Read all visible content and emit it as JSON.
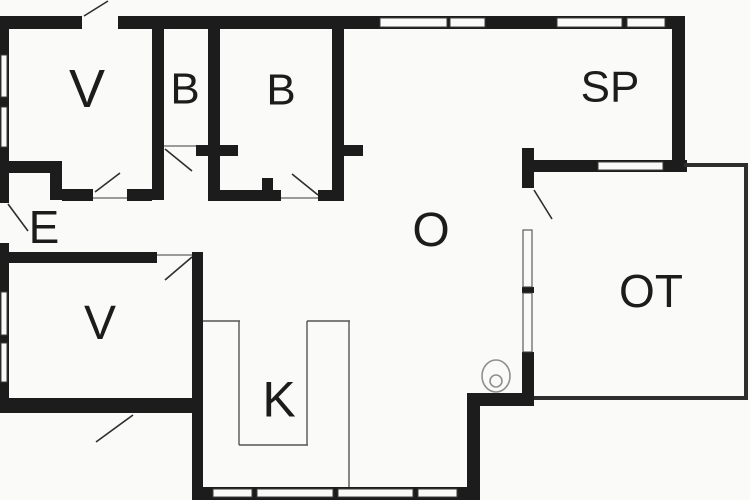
{
  "canvas": {
    "width": 750,
    "height": 500,
    "background": "#fafaf8",
    "wall_color": "#1c1c1c",
    "edge_color": "#2e2e2e",
    "line_color": "#3c3c3c",
    "counter_color": "#555555",
    "symbol_color": "#8f8f8f",
    "text_color": "#1c1c1c"
  },
  "rooms": [
    {
      "name": "room-label-bedroom-1",
      "label": "V",
      "x": 87,
      "y": 88,
      "size": 54
    },
    {
      "name": "room-label-bath-1",
      "label": "B",
      "x": 185,
      "y": 88,
      "size": 44
    },
    {
      "name": "room-label-bath-2",
      "label": "B",
      "x": 281,
      "y": 89,
      "size": 44
    },
    {
      "name": "room-label-dining",
      "label": "SP",
      "x": 610,
      "y": 86,
      "size": 44
    },
    {
      "name": "room-label-entry",
      "label": "E",
      "x": 44,
      "y": 227,
      "size": 46
    },
    {
      "name": "room-label-living",
      "label": "O",
      "x": 431,
      "y": 229,
      "size": 48
    },
    {
      "name": "room-label-bedroom-2",
      "label": "V",
      "x": 100,
      "y": 322,
      "size": 48
    },
    {
      "name": "room-label-kitchen",
      "label": "K",
      "x": 279,
      "y": 399,
      "size": 50
    },
    {
      "name": "room-label-terrace",
      "label": "OT",
      "x": 651,
      "y": 291,
      "size": 46
    }
  ],
  "walls": [
    {
      "name": "wall-top",
      "x": 8,
      "y": 16,
      "w": 677,
      "h": 13
    },
    {
      "name": "wall-left",
      "x": 0,
      "y": 16,
      "w": 9,
      "h": 397
    },
    {
      "name": "wall-v2-bottom",
      "x": 0,
      "y": 398,
      "w": 203,
      "h": 15
    },
    {
      "name": "wall-v2-right-k-left",
      "x": 192,
      "y": 252,
      "w": 11,
      "h": 248
    },
    {
      "name": "wall-k-bottom",
      "x": 192,
      "y": 487,
      "w": 288,
      "h": 13
    },
    {
      "name": "wall-k-right",
      "x": 467,
      "y": 393,
      "w": 13,
      "h": 107
    },
    {
      "name": "wall-o-bottom",
      "x": 467,
      "y": 393,
      "w": 67,
      "h": 13
    },
    {
      "name": "wall-ot-left-upper",
      "x": 522,
      "y": 148,
      "w": 12,
      "h": 40
    },
    {
      "name": "wall-ot-left-mullion",
      "x": 522,
      "y": 287,
      "w": 12,
      "h": 6
    },
    {
      "name": "wall-ot-left-lower",
      "x": 522,
      "y": 352,
      "w": 12,
      "h": 54
    },
    {
      "name": "wall-sp-bottom",
      "x": 522,
      "y": 160,
      "w": 165,
      "h": 12
    },
    {
      "name": "wall-sp-right",
      "x": 672,
      "y": 16,
      "w": 13,
      "h": 156
    },
    {
      "name": "wall-v1-b1",
      "x": 152,
      "y": 16,
      "w": 12,
      "h": 184
    },
    {
      "name": "wall-e-step-top",
      "x": 0,
      "y": 161,
      "w": 62,
      "h": 12
    },
    {
      "name": "wall-e-step-jog",
      "x": 50,
      "y": 173,
      "w": 12,
      "h": 27
    },
    {
      "name": "wall-v1-bottom-left",
      "x": 62,
      "y": 189,
      "w": 31,
      "h": 12
    },
    {
      "name": "wall-v1-bottom-right",
      "x": 127,
      "y": 189,
      "w": 25,
      "h": 12
    },
    {
      "name": "wall-b1-b2",
      "x": 208,
      "y": 16,
      "w": 12,
      "h": 185
    },
    {
      "name": "wall-b1-bottom-stub",
      "x": 196,
      "y": 145,
      "w": 42,
      "h": 11
    },
    {
      "name": "wall-b2-bottom-left",
      "x": 208,
      "y": 190,
      "w": 73,
      "h": 11
    },
    {
      "name": "wall-b2-bottom-right",
      "x": 318,
      "y": 190,
      "w": 26,
      "h": 11
    },
    {
      "name": "wall-b2-stub",
      "x": 262,
      "y": 178,
      "w": 11,
      "h": 12
    },
    {
      "name": "wall-b2-o",
      "x": 332,
      "y": 16,
      "w": 12,
      "h": 181
    },
    {
      "name": "wall-b2-o-stub",
      "x": 344,
      "y": 145,
      "w": 19,
      "h": 11
    },
    {
      "name": "wall-v2-top",
      "x": 0,
      "y": 252,
      "w": 157,
      "h": 11
    }
  ],
  "terrace_edges": [
    {
      "name": "terrace-edge-top",
      "x": 684,
      "y": 163,
      "w": 64,
      "h": 4
    },
    {
      "name": "terrace-edge-right",
      "x": 744,
      "y": 163,
      "w": 4,
      "h": 237
    },
    {
      "name": "terrace-edge-bottom",
      "x": 534,
      "y": 396,
      "w": 214,
      "h": 4
    }
  ],
  "door_gaps": [
    {
      "name": "gap-front-door",
      "x": 82,
      "y": 14,
      "w": 36,
      "h": 17
    },
    {
      "name": "gap-entry-door",
      "x": -1,
      "y": 203,
      "w": 11,
      "h": 40
    }
  ],
  "windows": [
    {
      "name": "window-top-1",
      "x": 380,
      "y": 18,
      "w": 67,
      "h": 9
    },
    {
      "name": "window-top-2",
      "x": 450,
      "y": 18,
      "w": 35,
      "h": 9
    },
    {
      "name": "window-top-3",
      "x": 557,
      "y": 18,
      "w": 65,
      "h": 9
    },
    {
      "name": "window-top-4",
      "x": 627,
      "y": 18,
      "w": 38,
      "h": 9
    },
    {
      "name": "window-left-1",
      "x": 1,
      "y": 55,
      "w": 6,
      "h": 42
    },
    {
      "name": "window-left-2",
      "x": 1,
      "y": 107,
      "w": 6,
      "h": 40
    },
    {
      "name": "window-left-3",
      "x": 1,
      "y": 292,
      "w": 6,
      "h": 43
    },
    {
      "name": "window-left-4",
      "x": 1,
      "y": 343,
      "w": 6,
      "h": 39
    },
    {
      "name": "window-sp-bottom",
      "x": 598,
      "y": 162,
      "w": 65,
      "h": 8
    },
    {
      "name": "window-ot-1",
      "x": 523,
      "y": 230,
      "w": 9,
      "h": 57
    },
    {
      "name": "window-ot-2",
      "x": 523,
      "y": 293,
      "w": 9,
      "h": 59
    },
    {
      "name": "window-k-1",
      "x": 213,
      "y": 489,
      "w": 39,
      "h": 8
    },
    {
      "name": "window-k-2",
      "x": 257,
      "y": 489,
      "w": 76,
      "h": 8
    },
    {
      "name": "window-k-3",
      "x": 338,
      "y": 489,
      "w": 75,
      "h": 8
    },
    {
      "name": "window-k-4",
      "x": 418,
      "y": 489,
      "w": 39,
      "h": 8
    }
  ],
  "thresholds": [
    {
      "name": "threshold-b1",
      "x1": 164,
      "y1": 146,
      "x2": 196,
      "y2": 146
    },
    {
      "name": "threshold-v1",
      "x1": 93,
      "y1": 198,
      "x2": 127,
      "y2": 198
    },
    {
      "name": "threshold-b2",
      "x1": 281,
      "y1": 198,
      "x2": 318,
      "y2": 198
    },
    {
      "name": "threshold-v2",
      "x1": 157,
      "y1": 255,
      "x2": 192,
      "y2": 255
    }
  ],
  "door_swings": [
    {
      "name": "door-swing-front",
      "x1": 84,
      "y1": 16,
      "x2": 108,
      "y2": 1
    },
    {
      "name": "door-swing-entry",
      "x1": 8,
      "y1": 204,
      "x2": 28,
      "y2": 231
    },
    {
      "name": "door-swing-v1",
      "x1": 95,
      "y1": 192,
      "x2": 120,
      "y2": 173
    },
    {
      "name": "door-swing-b1",
      "x1": 165,
      "y1": 149,
      "x2": 192,
      "y2": 171
    },
    {
      "name": "door-swing-b2",
      "x1": 292,
      "y1": 174,
      "x2": 318,
      "y2": 195
    },
    {
      "name": "door-swing-v2",
      "x1": 165,
      "y1": 280,
      "x2": 192,
      "y2": 257
    },
    {
      "name": "door-swing-v2-ext",
      "x1": 96,
      "y1": 442,
      "x2": 133,
      "y2": 415
    },
    {
      "name": "door-swing-ot",
      "x1": 534,
      "y1": 190,
      "x2": 552,
      "y2": 219
    }
  ],
  "counter_lines": [
    {
      "name": "counter-left",
      "x1": 203,
      "y1": 321,
      "x2": 240,
      "y2": 321
    },
    {
      "name": "counter-island-left",
      "x1": 239,
      "y1": 321,
      "x2": 239,
      "y2": 445
    },
    {
      "name": "counter-island-bottom",
      "x1": 239,
      "y1": 445,
      "x2": 308,
      "y2": 445
    },
    {
      "name": "counter-island-right",
      "x1": 307,
      "y1": 321,
      "x2": 307,
      "y2": 445
    },
    {
      "name": "counter-right-top",
      "x1": 307,
      "y1": 321,
      "x2": 350,
      "y2": 321
    },
    {
      "name": "counter-right",
      "x1": 349,
      "y1": 321,
      "x2": 349,
      "y2": 487
    }
  ],
  "symbols": {
    "stove": {
      "name": "stove-icon",
      "cx": 496,
      "cy": 376,
      "rx": 14,
      "ry": 16,
      "inner_cx": 496,
      "inner_cy": 381,
      "inner_r": 6
    }
  }
}
